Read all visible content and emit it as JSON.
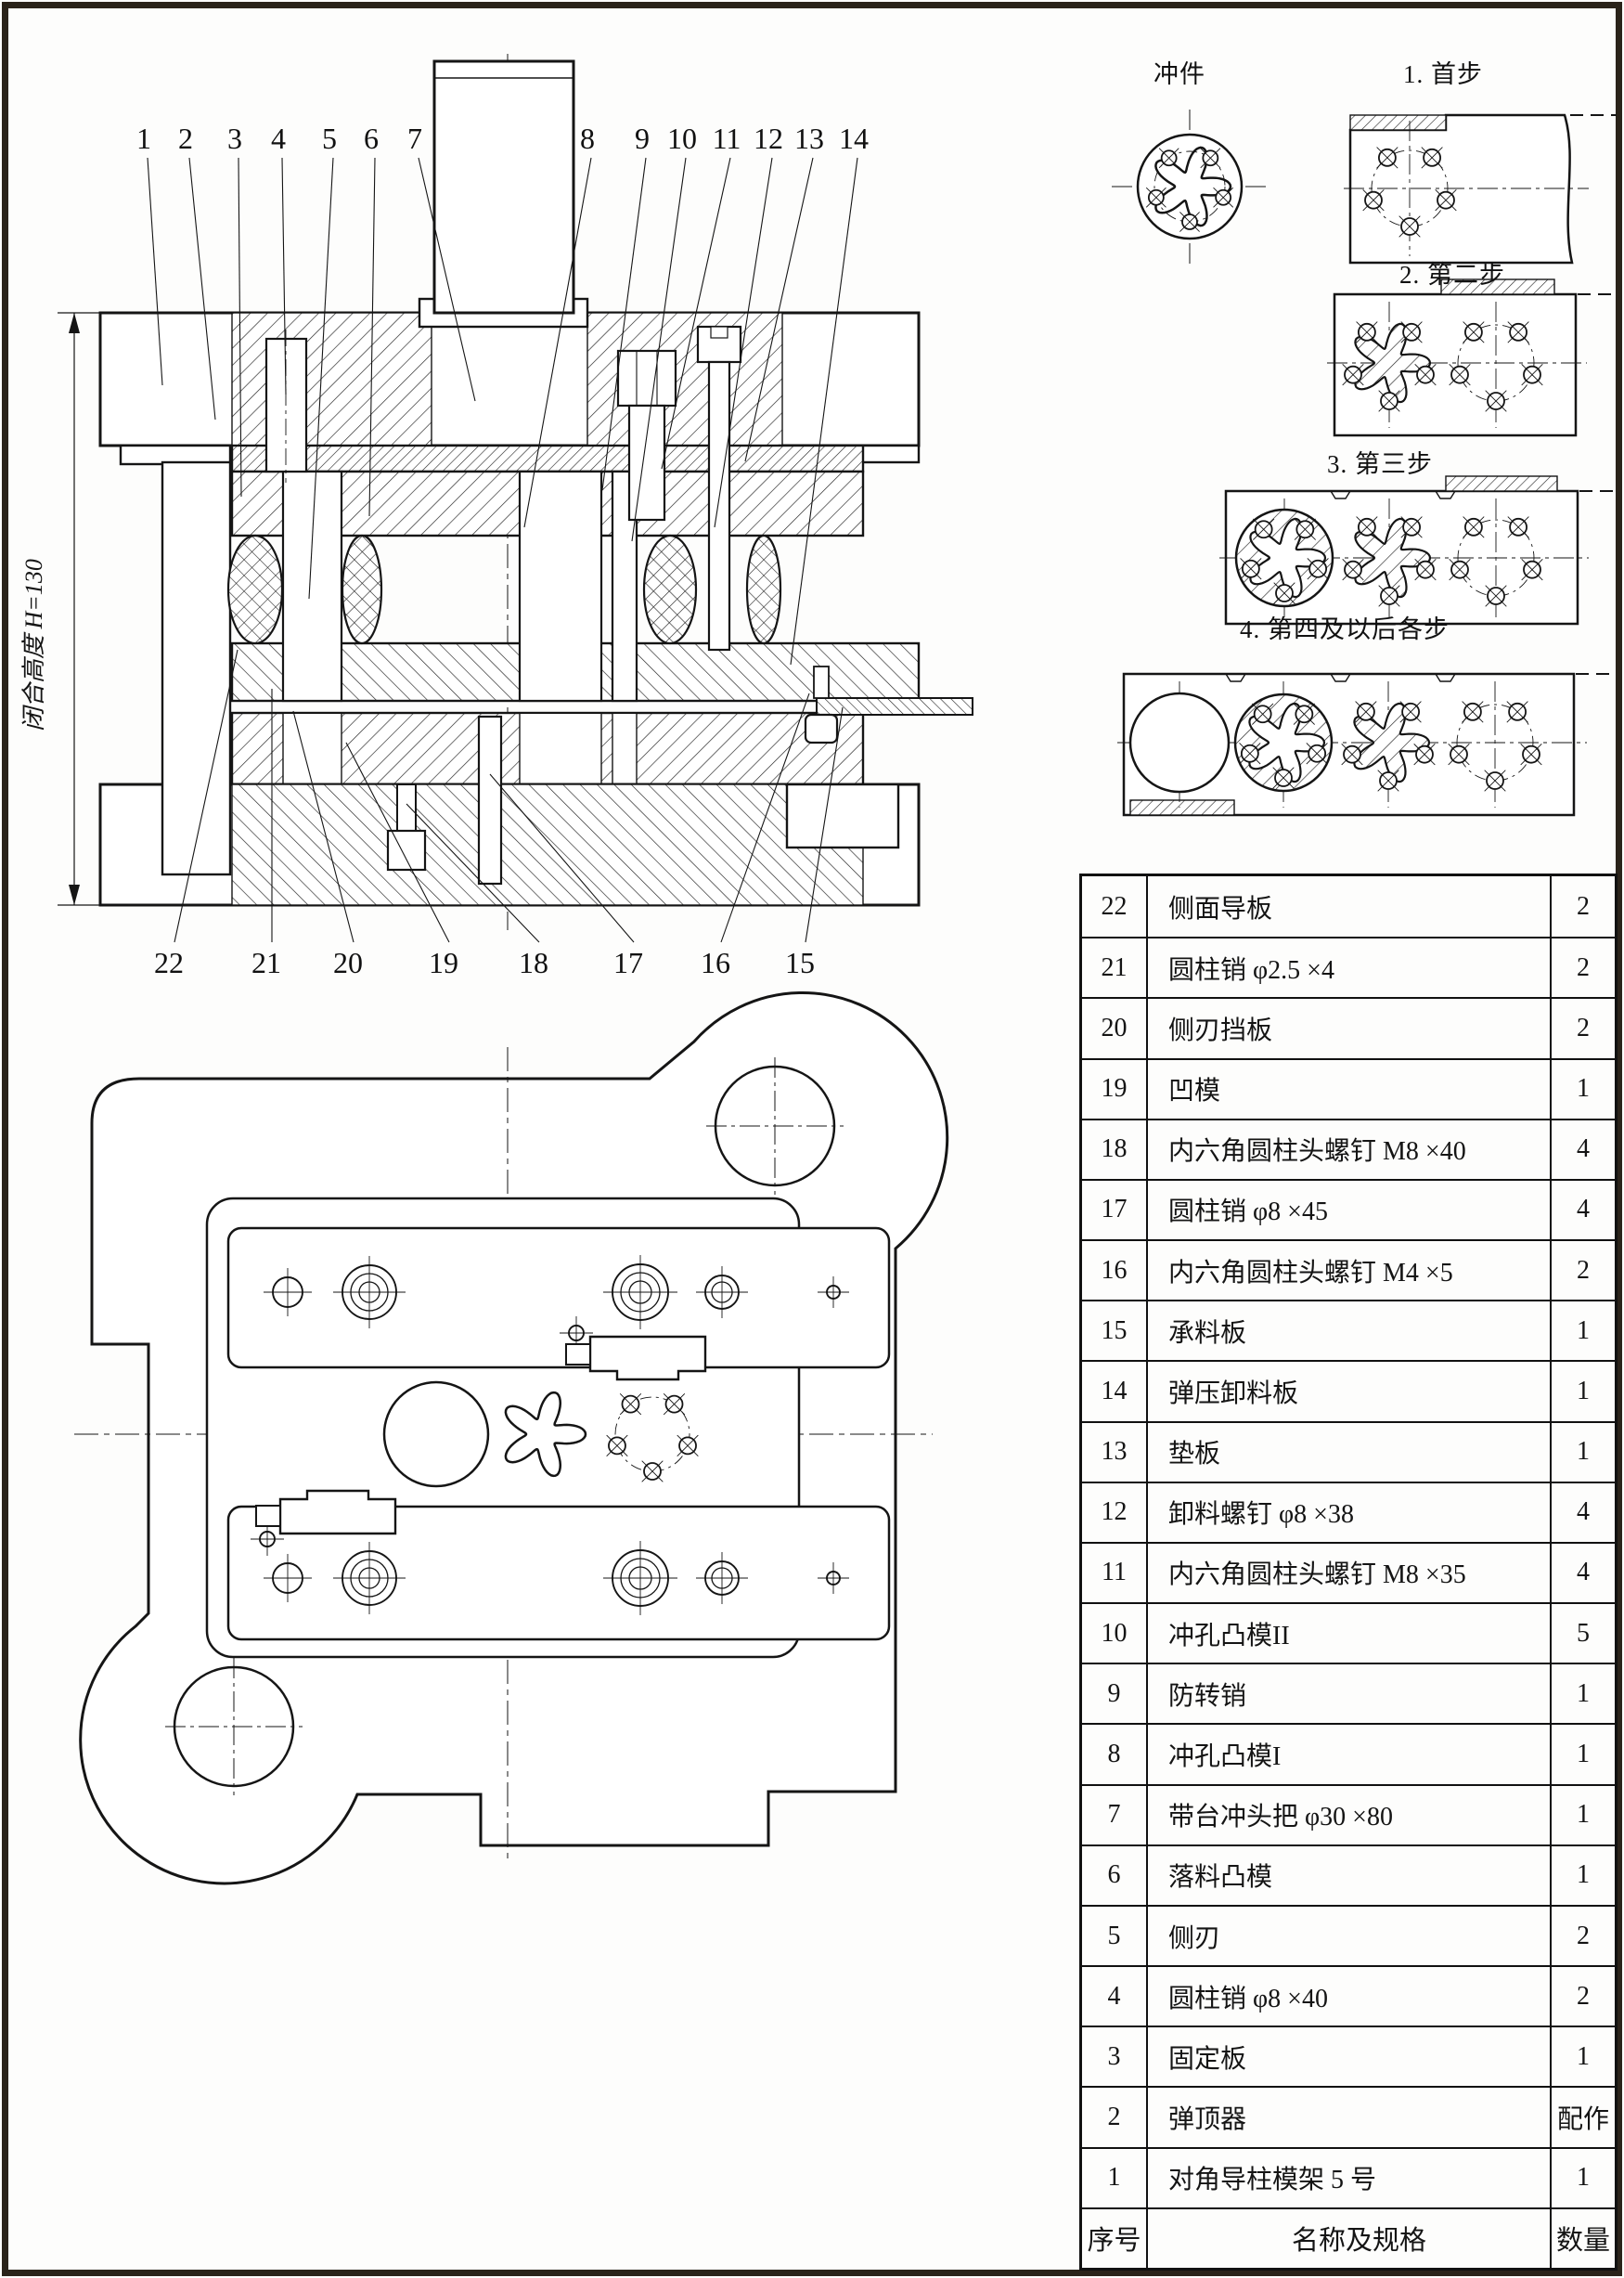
{
  "front_view": {
    "dimension_label": "闭合高度 H=130",
    "callouts_top": [
      "1",
      "2",
      "3",
      "4",
      "5",
      "6",
      "7",
      "8",
      "9",
      "10",
      "11",
      "12",
      "13",
      "14"
    ],
    "callouts_bottom": [
      "22",
      "21",
      "20",
      "19",
      "18",
      "17",
      "16",
      "15"
    ]
  },
  "strip_layout": {
    "part_label": "冲件",
    "step_labels": [
      "1. 首步",
      "2. 第二步",
      "3. 第三步",
      "4. 第四及以后各步"
    ]
  },
  "parts_table": {
    "header": {
      "no": "序号",
      "name": "名称及规格",
      "qty": "数量"
    },
    "rows": [
      {
        "no": "22",
        "name": "侧面导板",
        "qty": "2"
      },
      {
        "no": "21",
        "name": "圆柱销 φ2.5 ×4",
        "qty": "2"
      },
      {
        "no": "20",
        "name": "侧刃挡板",
        "qty": "2"
      },
      {
        "no": "19",
        "name": "凹模",
        "qty": "1"
      },
      {
        "no": "18",
        "name": "内六角圆柱头螺钉 M8 ×40",
        "qty": "4"
      },
      {
        "no": "17",
        "name": "圆柱销 φ8 ×45",
        "qty": "4"
      },
      {
        "no": "16",
        "name": "内六角圆柱头螺钉 M4 ×5",
        "qty": "2"
      },
      {
        "no": "15",
        "name": "承料板",
        "qty": "1"
      },
      {
        "no": "14",
        "name": "弹压卸料板",
        "qty": "1"
      },
      {
        "no": "13",
        "name": "垫板",
        "qty": "1"
      },
      {
        "no": "12",
        "name": "卸料螺钉 φ8 ×38",
        "qty": "4"
      },
      {
        "no": "11",
        "name": "内六角圆柱头螺钉 M8 ×35",
        "qty": "4"
      },
      {
        "no": "10",
        "name": "冲孔凸模II",
        "qty": "5"
      },
      {
        "no": "9",
        "name": "防转销",
        "qty": "1"
      },
      {
        "no": "8",
        "name": "冲孔凸模I",
        "qty": "1"
      },
      {
        "no": "7",
        "name": "带台冲头把 φ30 ×80",
        "qty": "1"
      },
      {
        "no": "6",
        "name": "落料凸模",
        "qty": "1"
      },
      {
        "no": "5",
        "name": "侧刃",
        "qty": "2"
      },
      {
        "no": "4",
        "name": "圆柱销 φ8 ×40",
        "qty": "2"
      },
      {
        "no": "3",
        "name": "固定板",
        "qty": "1"
      },
      {
        "no": "2",
        "name": "弹顶器",
        "qty": "配作"
      },
      {
        "no": "1",
        "name": "对角导柱模架 5 号",
        "qty": "1"
      }
    ]
  }
}
